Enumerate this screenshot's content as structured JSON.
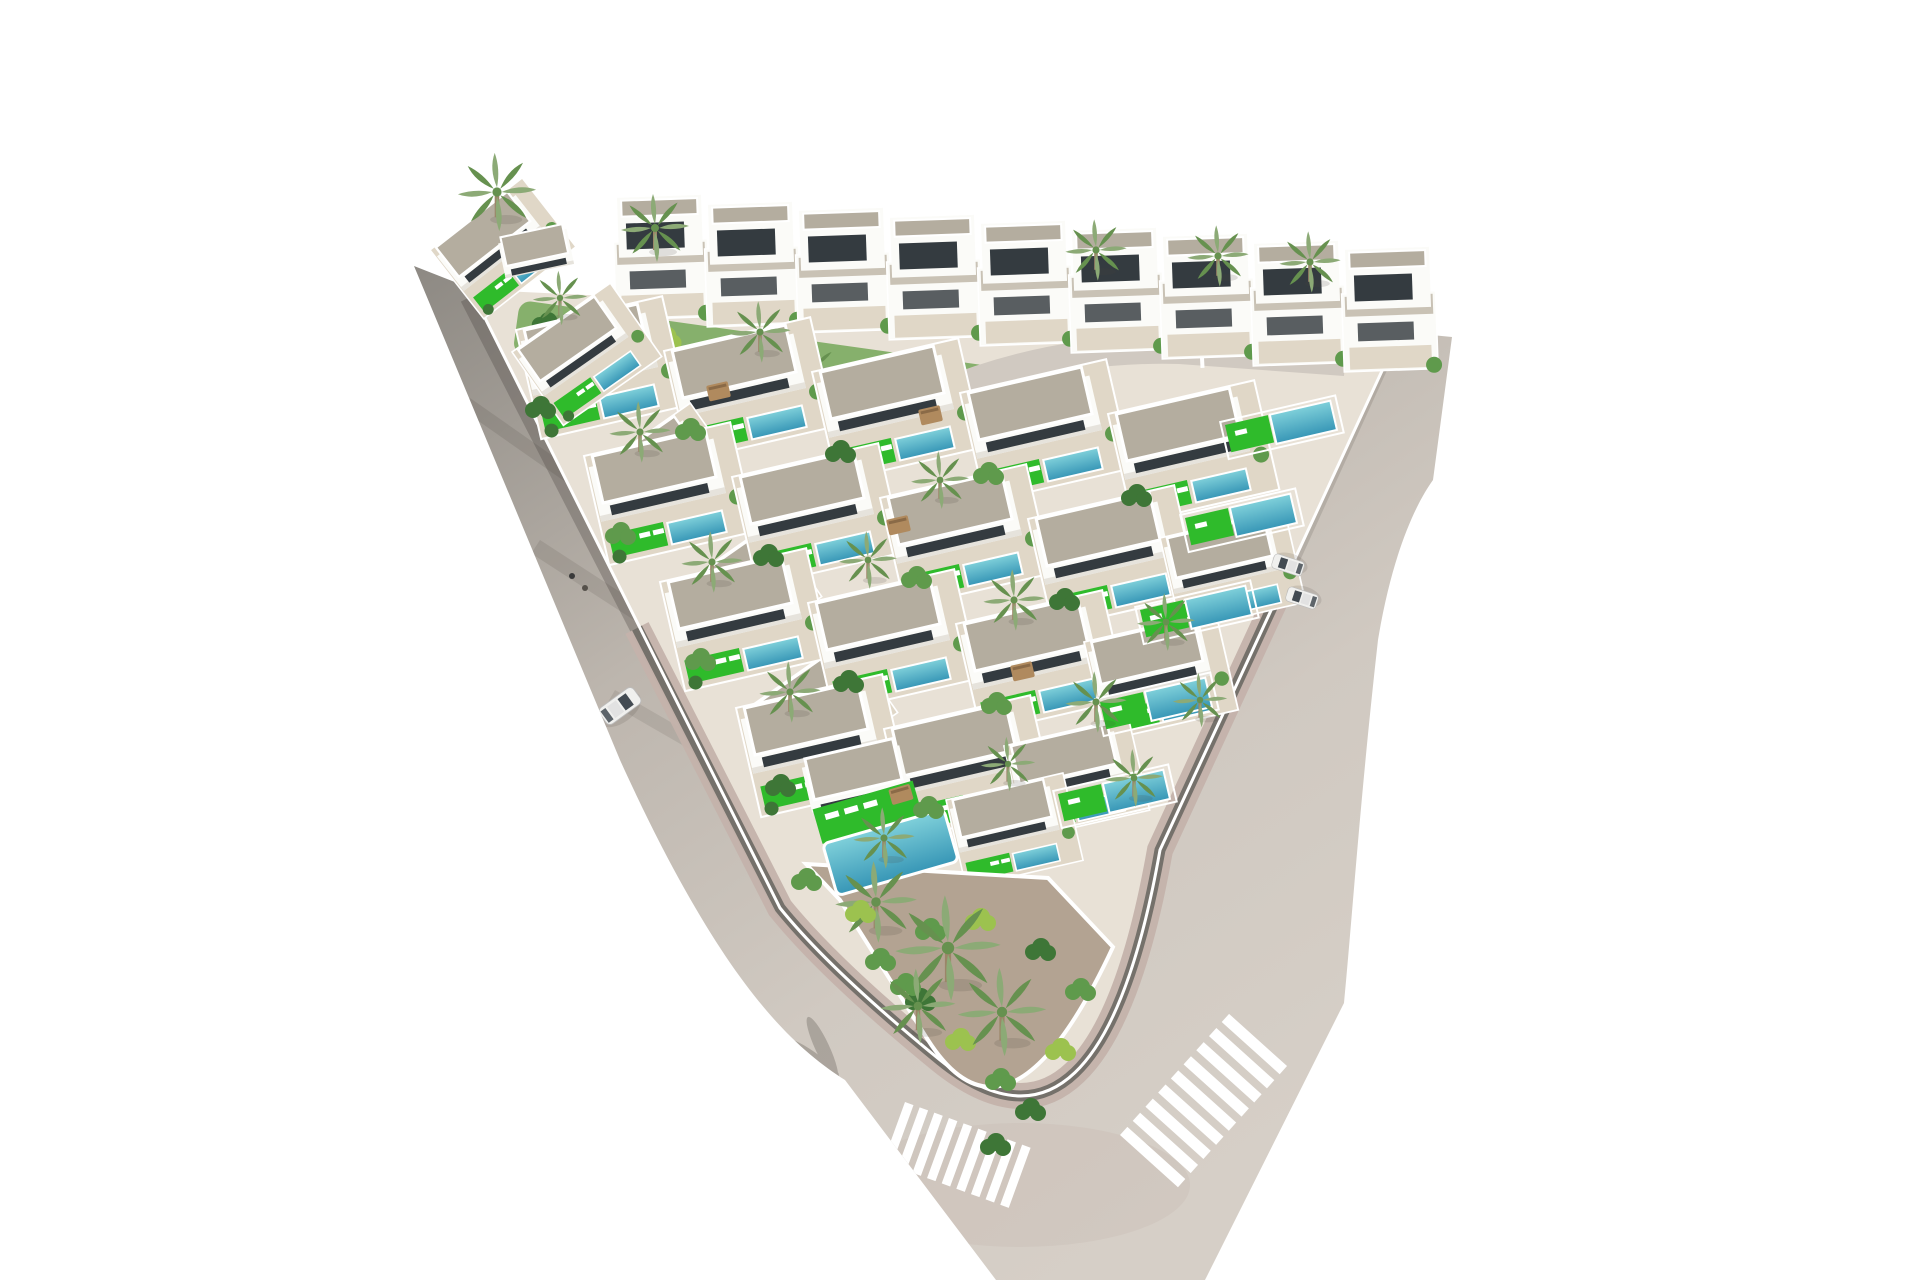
{
  "meta": {
    "kind": "aerial-3d-architectural-render",
    "description": "Aerial axonometric 3D render of a triangular residential development of white Mediterranean villas with flat gravel roofs, private turquoise pools, bright green turf patches and palm trees; two perimeter roads meet at a rounded bottom corner with two zebra crossings; a single white car drives on the left road; white background, no sky."
  },
  "palette": {
    "background": "#ffffff",
    "road-light": "#d0c9c1",
    "road-shaded": "#8d8983",
    "paver-pink": "#c4b2ab",
    "curb": "#75716b",
    "island-ground": "#e8e1d6",
    "terrace": "#e0d7c7",
    "roof-gravel": "#b4ad9f",
    "roof-light": "#c9c2b5",
    "villa-white": "#fbfbf8",
    "villa-shade": "#e6e3dc",
    "window-dark": "#343b40",
    "pool-blue": "#3796b6",
    "pool-light": "#7fd0da",
    "lawn-green": "#2fbb2b",
    "corridor-green": "#86b06c",
    "foliage": "#5f9a4c",
    "foliage-dark": "#3e7637",
    "palm-green": "#8caa76",
    "palm-dark": "#66914f",
    "palm-trunk": "#9b8568",
    "garden-gravel": "#b3a392",
    "crosswalk": "#ffffff",
    "car-body": "#f0f0ee",
    "car-glass": "#434b52",
    "pergola": "#b08a5e",
    "wall-white": "#ffffff",
    "shadow": "rgba(70,64,58,0.30)"
  },
  "scene": {
    "view": "aerial axonometric, white studio background",
    "site": {
      "shape": "triangular block with rounded bottom corner",
      "bounded_by": "shaded asphalt road on the left, light concrete road on the right, meeting at the rounded apex"
    },
    "roads": {
      "crosswalks": 2,
      "lane_dashes": true,
      "sidewalk_band": "pink paver strip with dark curb wall around the block",
      "cast_shadows": "boundary-wall and palm shadows fall across the roads"
    },
    "buildings": {
      "two_story_villas": 9,
      "single_story_villas": 25,
      "style": "white Mediterranean volumes, flat gravel roofs with white parapets, dark glazing"
    },
    "amenities": {
      "private_pools": 28,
      "community_pool": 1,
      "lawns": "saturated green turf patches with white sun loungers",
      "pergolas": 4
    },
    "vegetation": {
      "palm_trees": 26,
      "shrub_clusters": 38,
      "green_corridor": "planted slope strip between the upper villa rows"
    },
    "vehicles": {
      "moving_white_car": 1,
      "parked_cars": 2
    },
    "people": {
      "pedestrians": 2
    }
  }
}
